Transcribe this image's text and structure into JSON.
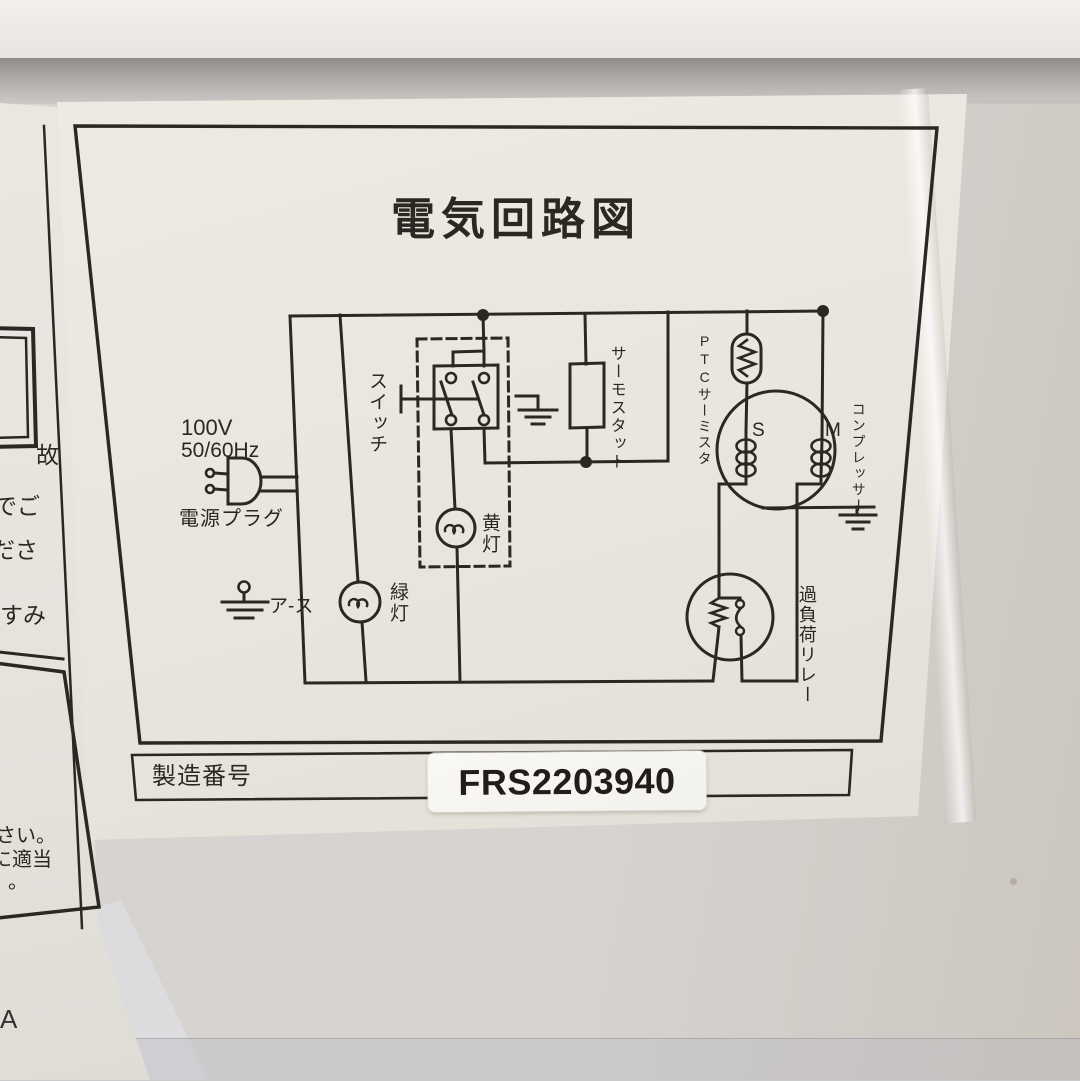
{
  "photo": {
    "main_label": {
      "title": "電気回路図",
      "serial_row": {
        "label": "製造番号",
        "value": "FRS2203940"
      },
      "diagram": {
        "voltage": "100V",
        "frequency": "50/60Hz",
        "power_plug": "電源プラグ",
        "earth": "ア-ス",
        "switch": "スイッチ",
        "yellow_lamp": "黄灯",
        "green_lamp": "緑灯",
        "thermostat": "サーモスタット",
        "ptc_prefix": "PTC",
        "ptc_suffix": "サーミスタ",
        "compressor": "コンプレッサー",
        "winding_s": "S",
        "winding_m": "M",
        "overload_relay": "過負荷リレー"
      }
    },
    "left_label": {
      "fragments": [
        "故",
        "でご",
        "ださ",
        "すみ",
        "さい。",
        "に適当",
        "。"
      ],
      "stray_char": "A"
    },
    "colors": {
      "ink": "#2b2722",
      "label_paper": "#eae6df",
      "wall": "#d6d3d0",
      "sticker": "#f8f6f2"
    }
  }
}
